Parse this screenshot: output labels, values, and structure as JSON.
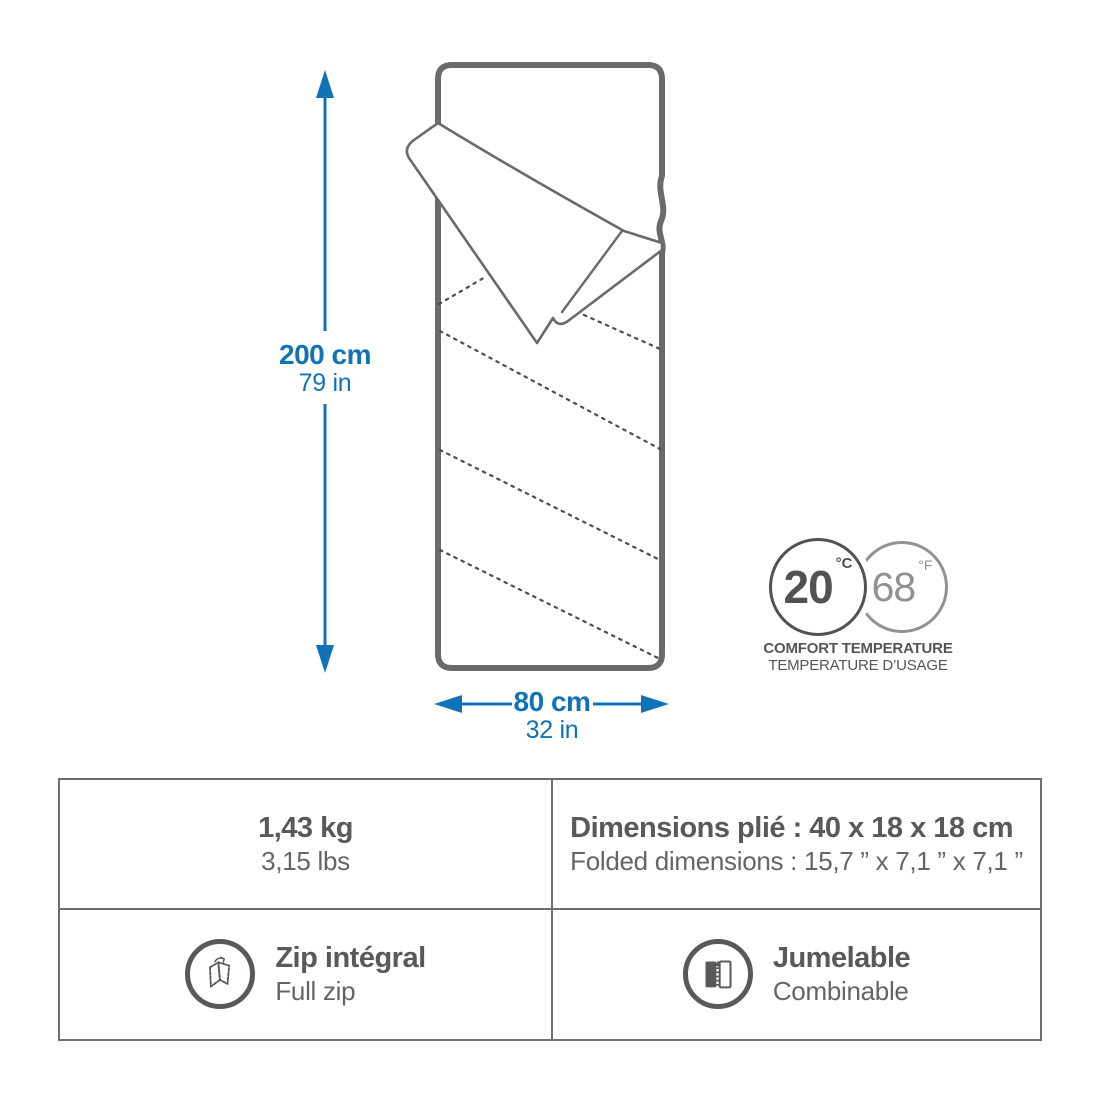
{
  "dimensions": {
    "height_primary": "200 cm",
    "height_secondary": "79 in",
    "width_primary": "80 cm",
    "width_secondary": "32 in"
  },
  "temperature": {
    "celsius_value": "20",
    "celsius_unit": "°C",
    "fahrenheit_value": "68",
    "fahrenheit_unit": "°F",
    "caption_line1": "COMFORT TEMPERATURE",
    "caption_line2": "TEMPERATURE D’USAGE"
  },
  "specs": {
    "weight": {
      "primary": "1,43 kg",
      "secondary": "3,15 lbs"
    },
    "folded": {
      "primary": "Dimensions plié : 40 x 18 x 18 cm",
      "secondary": "Folded dimensions : 15,7 ” x 7,1 ” x 7,1 ”"
    },
    "zip": {
      "primary": "Zip intégral",
      "secondary": "Full zip",
      "icon": "unfolded-blanket-icon"
    },
    "pairing": {
      "primary": "Jumelable",
      "secondary": "Combinable",
      "icon": "zipper-icon"
    }
  },
  "colors": {
    "accent_blue": "#1272b8",
    "text_gray": "#58595b",
    "light_gray": "#8f9193",
    "line_gray": "#696a6c"
  }
}
